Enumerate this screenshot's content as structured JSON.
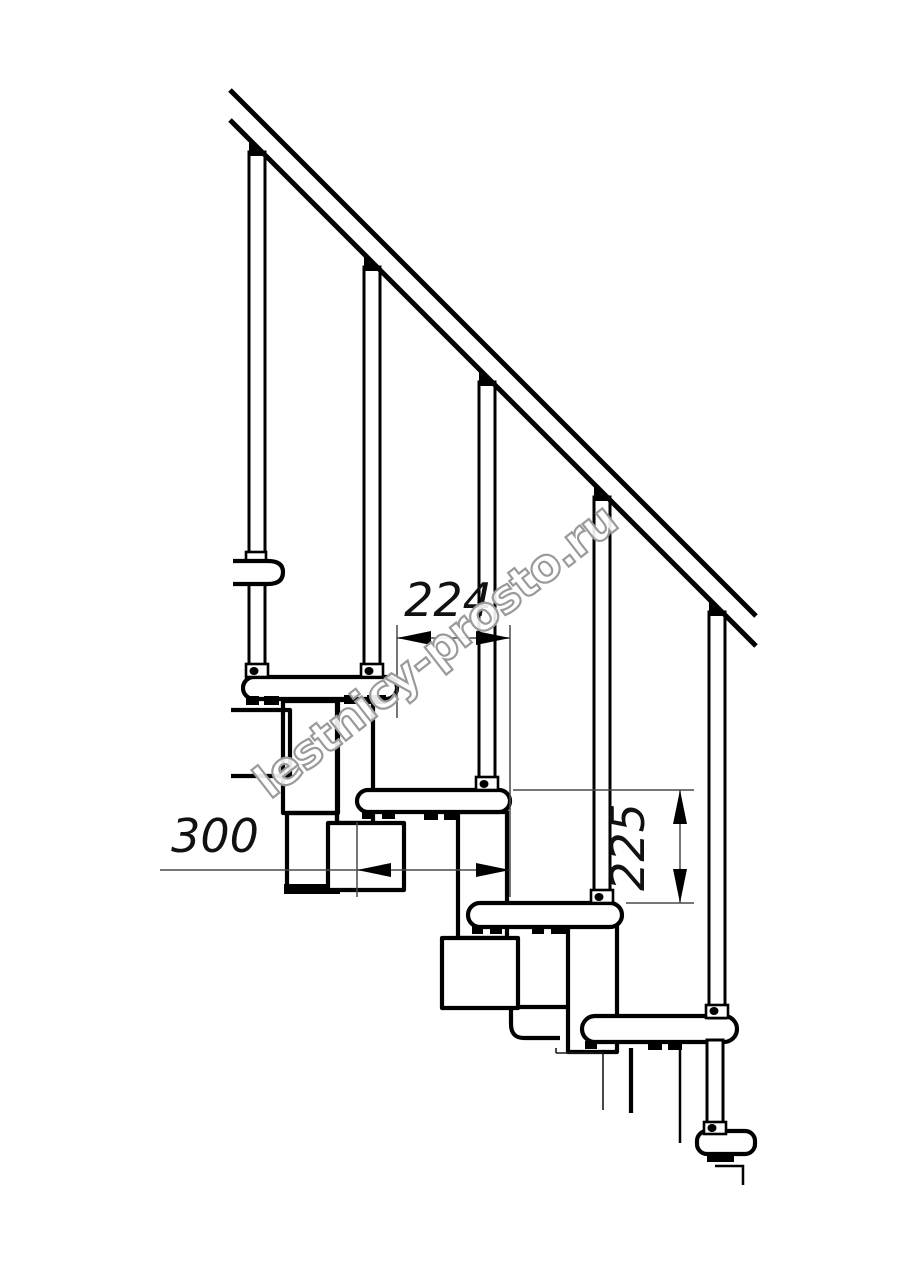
{
  "canvas": {
    "background": "#ffffff",
    "line_color": "#000000",
    "dimension_line_color": "#4a4a4a"
  },
  "drawing": {
    "type": "staircase-side-view-technical-drawing",
    "dims": {
      "going": {
        "value": "224"
      },
      "depth": {
        "value": "300"
      },
      "riser": {
        "value": "225"
      }
    }
  },
  "watermark": {
    "text": "lestnicy-prosto.ru",
    "outline": "#9a9a9a"
  }
}
